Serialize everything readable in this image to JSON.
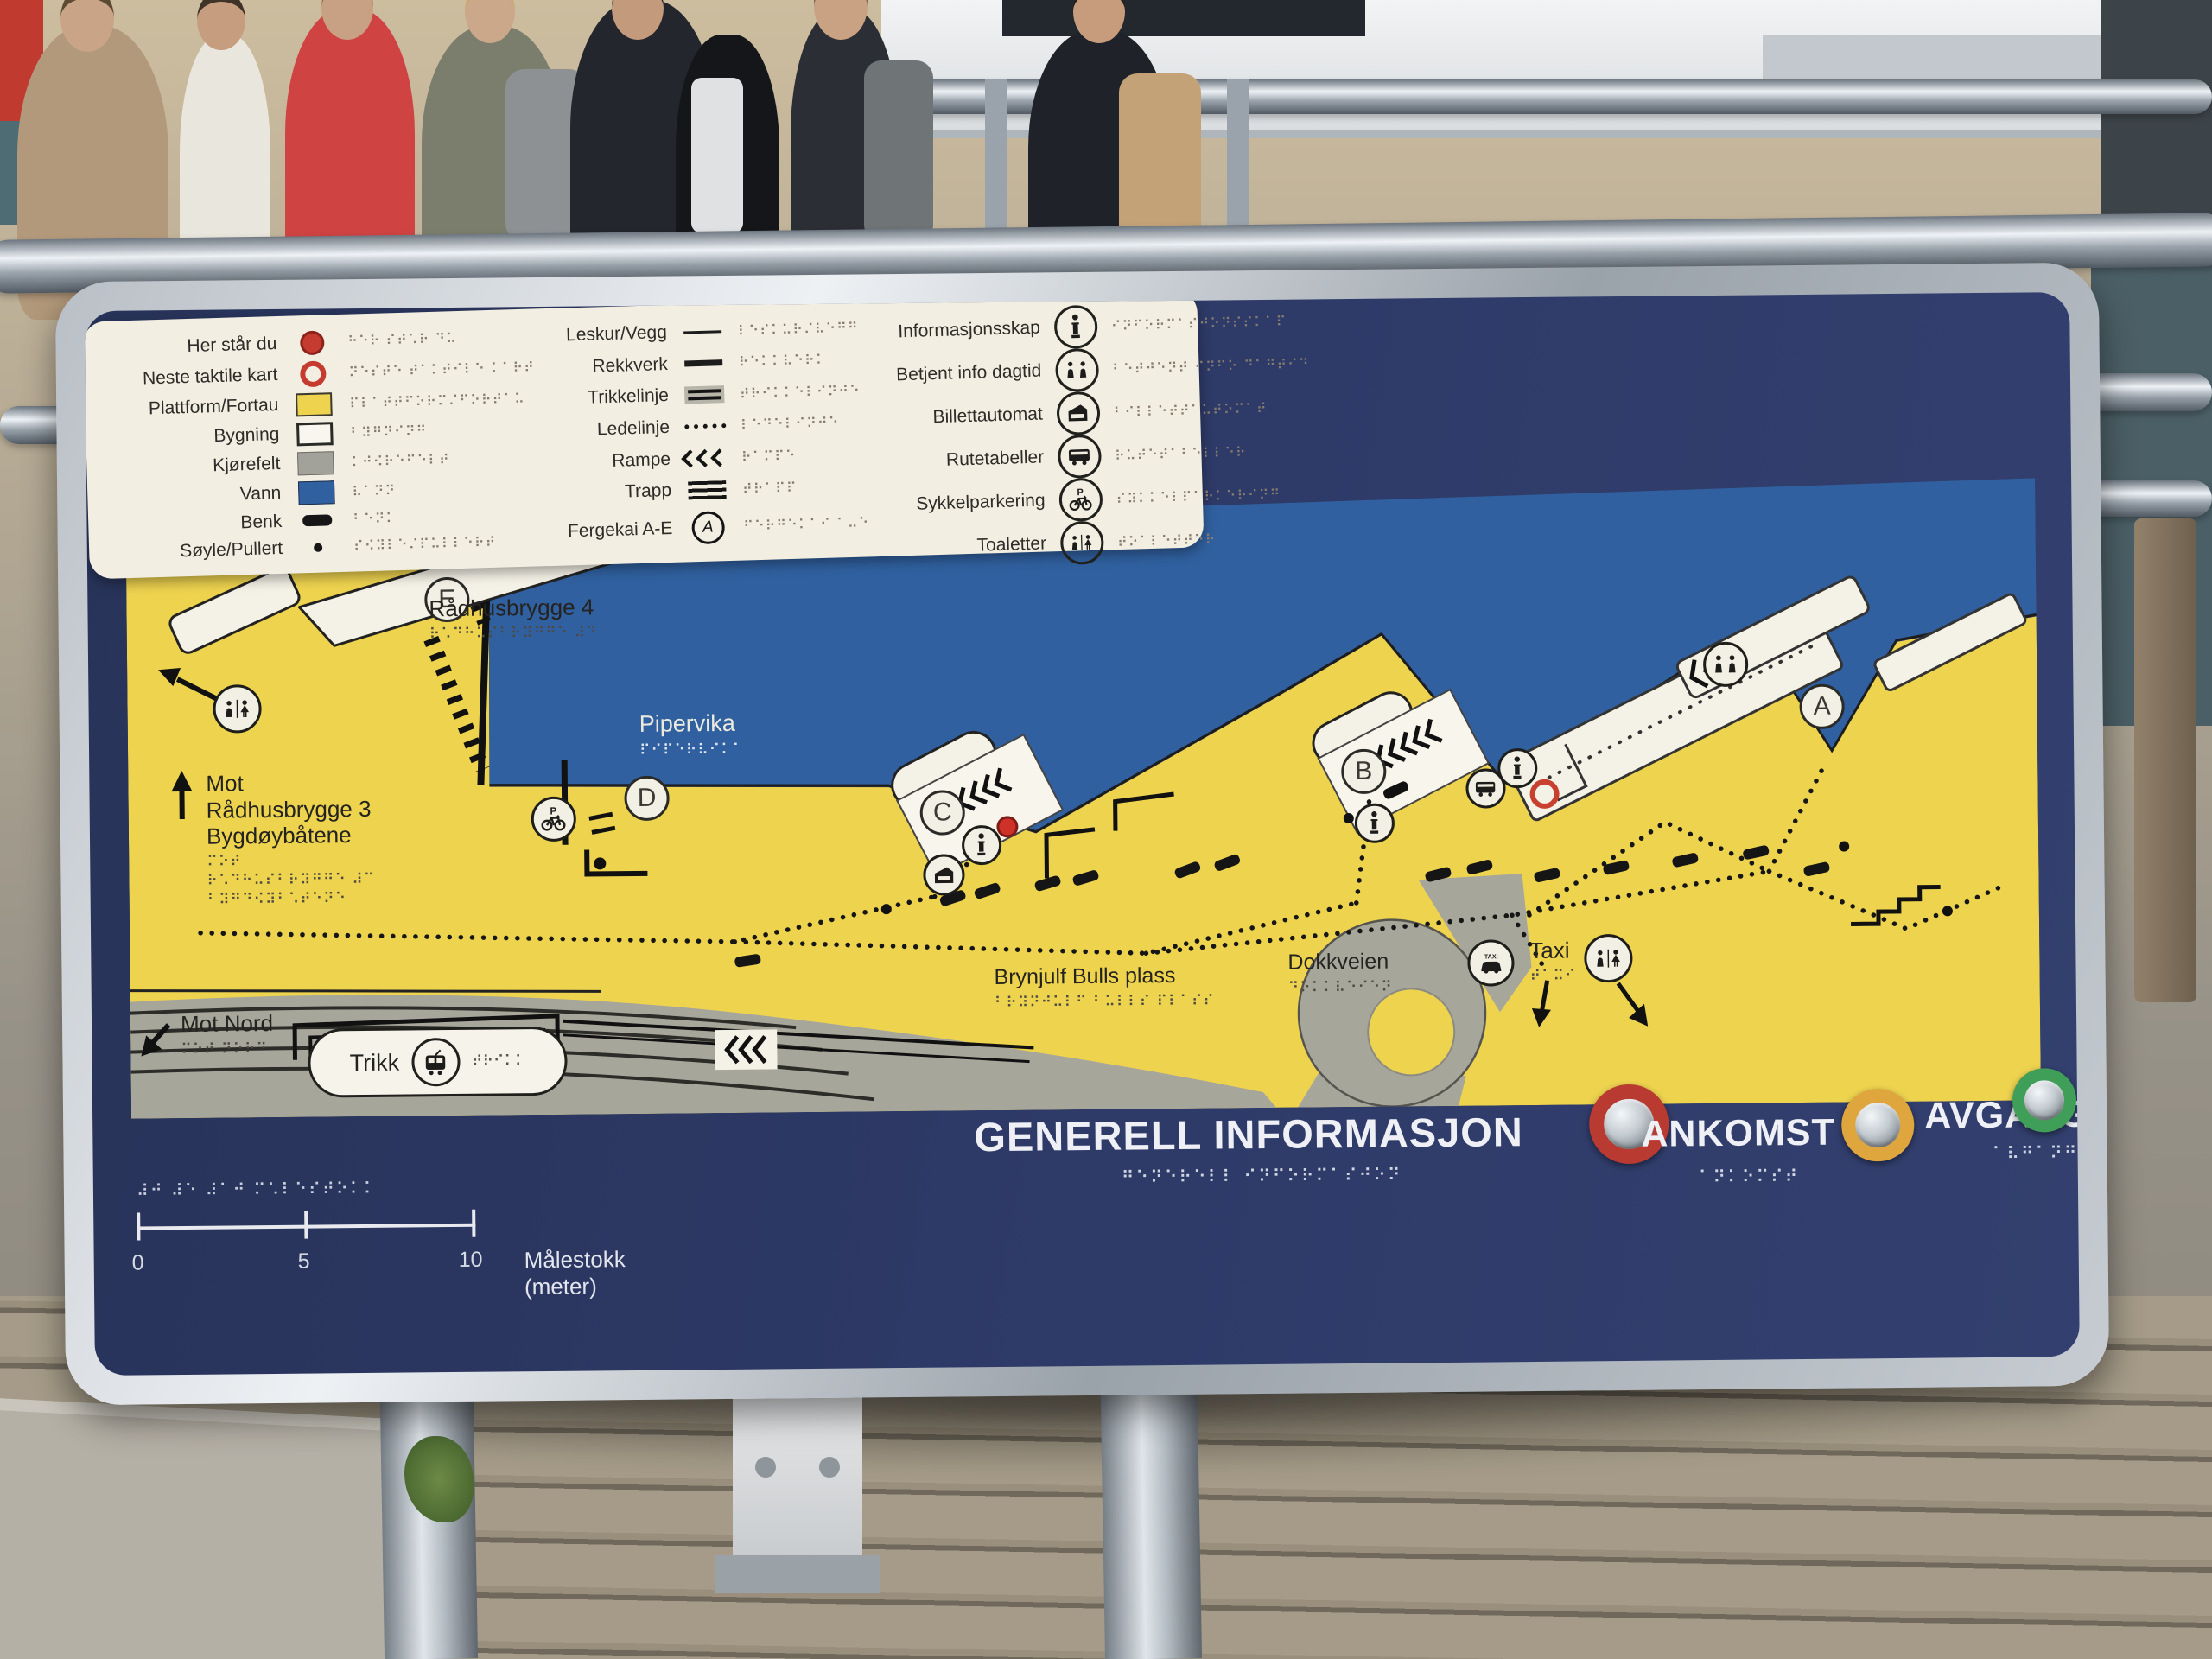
{
  "sign": {
    "title": "AKER BRYGGE",
    "title_braille": "⠁⠅⠑⠗ ⠃⠗⠽⠛⠛⠑",
    "colors": {
      "panel_navy": "#2c3863",
      "land_yellow": "#eed34f",
      "water_blue": "#30609f",
      "road_gray": "#a7a69b",
      "pier_white": "#f4f1e6",
      "info_button_ring": "#b93a31",
      "ankomst_button_ring": "#dfa63e",
      "avgang_button_ring": "#3f9e57",
      "her_star_du_red": "#c63b30"
    },
    "legend": {
      "left": [
        {
          "label": "Her står du",
          "symbol": "red-dot",
          "braille": "⠓⠑⠗ ⠎⠞⠡⠗ ⠙⠥"
        },
        {
          "label": "Neste taktile kart",
          "symbol": "red-ring",
          "braille": "⠝⠑⠎⠞⠑ ⠞⠁⠅⠞⠊⠇⠑ ⠅⠁⠗⠞"
        },
        {
          "label": "Plattform/Fortau",
          "symbol": "yellow-swatch",
          "braille": "⠏⠇⠁⠞⠞⠋⠕⠗⠍⠌⠋⠕⠗⠞⠁⠥"
        },
        {
          "label": "Bygning",
          "symbol": "white-swatch",
          "braille": "⠃⠽⠛⠝⠊⠝⠛"
        },
        {
          "label": "Kjørefelt",
          "symbol": "gray-swatch",
          "braille": "⠅⠚⠪⠗⠑⠋⠑⠇⠞"
        },
        {
          "label": "Vann",
          "symbol": "blue-swatch",
          "braille": "⠧⠁⠝⠝"
        },
        {
          "label": "Benk",
          "symbol": "black-bar",
          "braille": "⠃⠑⠝⠅"
        },
        {
          "label": "Søyle/Pullert",
          "symbol": "black-dot",
          "braille": "⠎⠪⠽⠇⠑⠌⠏⠥⠇⠇⠑⠗⠞"
        }
      ],
      "middle": [
        {
          "label": "Leskur/Vegg",
          "symbol": "thin-line",
          "braille": "⠇⠑⠎⠅⠥⠗⠌⠧⠑⠛⠛"
        },
        {
          "label": "Rekkverk",
          "symbol": "thick-line",
          "braille": "⠗⠑⠅⠅⠧⠑⠗⠅"
        },
        {
          "label": "Trikkelinje",
          "symbol": "double-line",
          "braille": "⠞⠗⠊⠅⠅⠑⠇⠊⠝⠚⠑"
        },
        {
          "label": "Ledelinje",
          "symbol": "dotted-line",
          "braille": "⠇⠑⠙⠑⠇⠊⠝⠚⠑"
        },
        {
          "label": "Rampe",
          "symbol": "chevrons",
          "braille": "⠗⠁⠍⠏⠑"
        },
        {
          "label": "Trapp",
          "symbol": "triple-line",
          "braille": "⠞⠗⠁⠏⠏"
        },
        {
          "label": "Fergekai A-E",
          "symbol": "circled-letter",
          "symbol_letter": "A",
          "braille": "⠋⠑⠗⠛⠑⠅⠁⠊ ⠁⠤⠑"
        }
      ],
      "right": [
        {
          "label": "Informasjonsskap",
          "symbol": "info-icon",
          "braille": "⠊⠝⠋⠕⠗⠍⠁⠎⠚⠕⠝⠎⠎⠅⠁⠏"
        },
        {
          "label": "Betjent info dagtid",
          "symbol": "staffed-info-icon",
          "braille": "⠃⠑⠞⠚⠑⠝⠞ ⠊⠝⠋⠕ ⠙⠁⠛⠞⠊⠙"
        },
        {
          "label": "Billettautomat",
          "symbol": "ticket-machine-icon",
          "braille": "⠃⠊⠇⠇⠑⠞⠞⠁⠥⠞⠕⠍⠁⠞"
        },
        {
          "label": "Rutetabeller",
          "symbol": "timetable-icon",
          "braille": "⠗⠥⠞⠑⠞⠁⠃⠑⠇⠇⠑⠗"
        },
        {
          "label": "Sykkelparkering",
          "symbol": "bike-parking-icon",
          "braille": "⠎⠽⠅⠅⠑⠇⠏⠁⠗⠅⠑⠗⠊⠝⠛"
        },
        {
          "label": "Toaletter",
          "symbol": "toilets-icon",
          "braille": "⠞⠕⠁⠇⠑⠞⠞⠑⠗"
        }
      ]
    },
    "map": {
      "labels": {
        "radhusbrygge4": {
          "text": "Rådhusbrygge 4",
          "braille": "⠗⠡⠙⠓⠥⠎⠃⠗⠽⠛⠛⠑ ⠼⠙"
        },
        "pipervika": {
          "text": "Pipervika",
          "braille": "⠏⠊⠏⠑⠗⠧⠊⠅⠁"
        },
        "mot_radhusbrygge": {
          "line1": "Mot",
          "line2": "Rådhusbrygge 3",
          "line3": "Bygdøybåtene",
          "braille1": "⠍⠕⠞",
          "braille2": "⠗⠡⠙⠓⠥⠎⠃⠗⠽⠛⠛⠑ ⠼⠉",
          "braille3": "⠃⠽⠛⠙⠪⠽⠃⠡⠞⠑⠝⠑"
        },
        "mot_nord": {
          "text": "Mot Nord",
          "braille": "⠍⠕⠞ ⠝⠕⠗⠙"
        },
        "trikk": {
          "text": "Trikk",
          "braille": "⠞⠗⠊⠅⠅"
        },
        "brynjulf": {
          "text": "Brynjulf Bulls plass",
          "braille": "⠃⠗⠽⠝⠚⠥⠇⠋ ⠃⠥⠇⠇⠎ ⠏⠇⠁⠎⠎"
        },
        "dokkveien": {
          "text": "Dokkveien",
          "braille": "⠙⠕⠅⠅⠧⠑⠊⠑⠝"
        },
        "taxi": {
          "text": "Taxi",
          "braille": "⠞⠁⠭⠊"
        }
      },
      "quay_letters": [
        "A",
        "B",
        "C",
        "D",
        "E"
      ]
    },
    "icons": {
      "bike_p": "P",
      "taxi_sign": "TAXI"
    },
    "scale": {
      "t0": "0",
      "t5": "5",
      "t10": "10",
      "label": "Målestokk (meter)",
      "braille": "⠼⠚  ⠼⠑  ⠼⠁⠚  ⠍⠡⠇⠑⠎⠞⠕⠅⠅"
    },
    "buttons": [
      {
        "label": "GENERELL INFORMASJON",
        "braille": "⠛⠑⠝⠑⠗⠑⠇⠇ ⠊⠝⠋⠕⠗⠍⠁⠎⠚⠕⠝",
        "ring": "#b93a31"
      },
      {
        "label": "ANKOMST",
        "braille": "⠁⠝⠅⠕⠍⠎⠞",
        "ring": "#dfa63e"
      },
      {
        "label": "AVGANG",
        "braille": "⠁⠧⠛⠁⠝⠛",
        "ring": "#3f9e57"
      }
    ]
  }
}
